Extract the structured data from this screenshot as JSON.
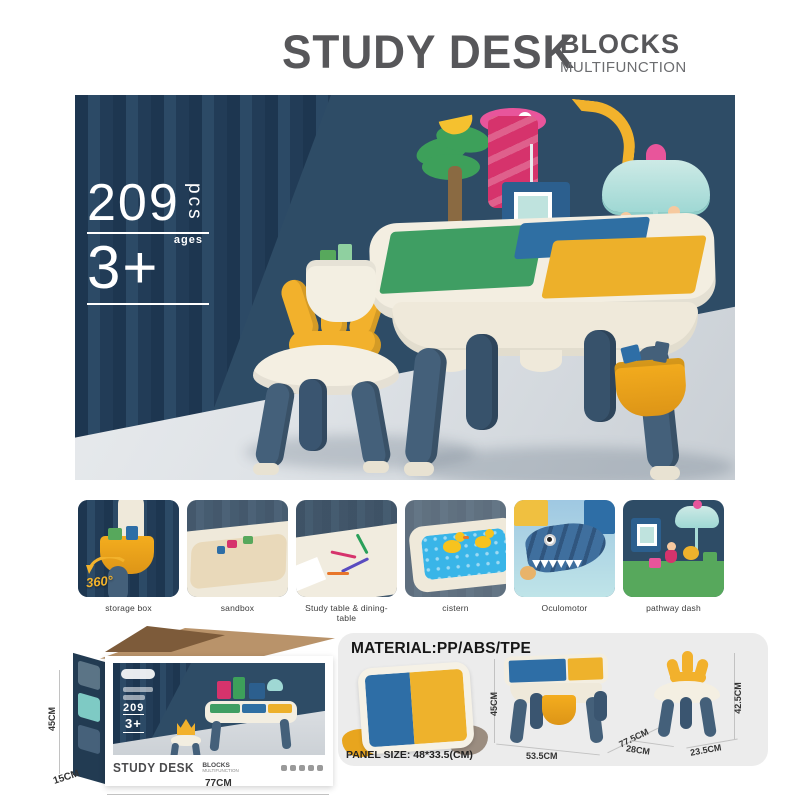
{
  "header": {
    "title": "STUDY DESK",
    "subtitle": "BLOCKS",
    "subtitle2": "MULTIFUNCTION"
  },
  "hero": {
    "pieces": "209",
    "pieces_unit": "pcs",
    "ages_label": "ages",
    "age": "3+"
  },
  "features": [
    {
      "caption": "storage box",
      "overlay": "360°"
    },
    {
      "caption": "sandbox"
    },
    {
      "caption": "Study table & dining-table"
    },
    {
      "caption": "cistern"
    },
    {
      "caption": "Oculomotor"
    },
    {
      "caption": "pathway dash"
    }
  ],
  "packaging": {
    "title": "STUDY DESK",
    "subtitle": "BLOCKS",
    "subtitle2": "MULTIFUNCTION",
    "pieces": "209",
    "age": "3+",
    "dim_height": "45CM",
    "dim_depth": "15CM",
    "dim_width": "77CM"
  },
  "specs": {
    "material_label": "MATERIAL:PP/ABS/TPE",
    "panel_size_label": "PANEL SIZE: 48*33.5(CM)",
    "table": {
      "height": "45CM",
      "width": "53.5CM",
      "length": "77.5CM"
    },
    "chair": {
      "seat_width": "28CM",
      "depth": "23.5CM",
      "height": "42.5CM"
    }
  },
  "colors": {
    "navy_bg": "#2e4c66",
    "curtain_dark": "#1d3650",
    "cream": "#f3eee1",
    "slate_leg": "#44607a",
    "crown_yellow": "#f2b12c",
    "bucket_orange": "#f0a21f",
    "plate_green": "#3f9e63",
    "plate_blue": "#2f6fa3",
    "plate_yellow": "#edb02a",
    "title_gray": "#57575a",
    "floor_gray": "#d9dde1"
  }
}
